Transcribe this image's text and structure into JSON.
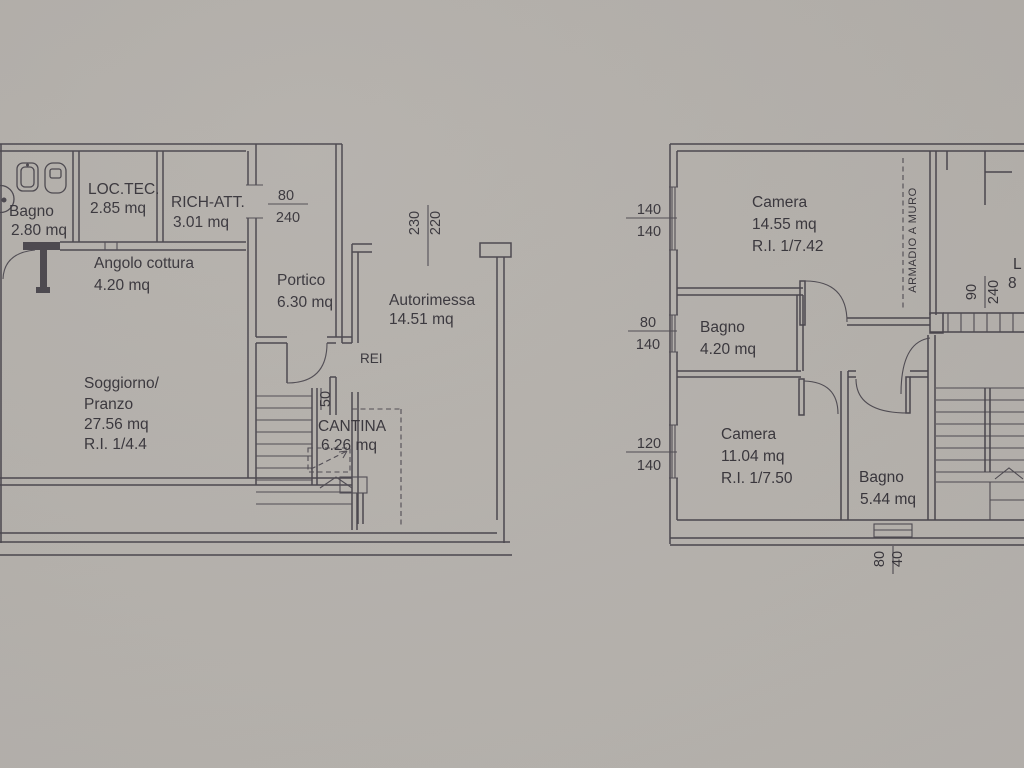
{
  "ground": {
    "rooms": {
      "bagno": {
        "name": "Bagno",
        "area": "2.80 mq"
      },
      "loc_tec": {
        "name": "LOC.TEC.",
        "area": "2.85 mq"
      },
      "rich_att": {
        "name": "RICH-ATT.",
        "area": "3.01 mq"
      },
      "angolo_cottura": {
        "name": "Angolo cottura",
        "area": "4.20 mq"
      },
      "portico": {
        "name": "Portico",
        "area": "6.30 mq"
      },
      "autorimessa": {
        "name": "Autorimessa",
        "area": "14.51 mq"
      },
      "soggiorno": {
        "name": "Soggiorno/",
        "name2": "Pranzo",
        "area": "27.56 mq",
        "ri": "R.I. 1/4.4"
      },
      "cantina": {
        "name": "CANTINA",
        "area": "6.26 mq"
      }
    },
    "annotations": {
      "fire_rating": "REI",
      "stair_width": "50"
    },
    "dimensions": {
      "door": {
        "w": "80",
        "h": "240"
      },
      "garage_door": {
        "w": "230",
        "h": "220"
      }
    }
  },
  "first": {
    "rooms": {
      "camera1": {
        "name": "Camera",
        "area": "14.55 mq",
        "ri": "R.I. 1/7.42"
      },
      "bagno1": {
        "name": "Bagno",
        "area": "4.20 mq"
      },
      "camera2": {
        "name": "Camera",
        "area": "11.04 mq",
        "ri": "R.I. 1/7.50"
      },
      "bagno2": {
        "name": "Bagno",
        "area": "5.44 mq"
      }
    },
    "annotations": {
      "wardrobe": "ARMADIO A MURO",
      "partial_label_1": "L",
      "partial_label_2": "8"
    },
    "dimensions": {
      "window1": {
        "w": "140",
        "h": "140"
      },
      "window2": {
        "w": "80",
        "h": "140"
      },
      "window3": {
        "w": "120",
        "h": "140"
      },
      "door": {
        "w": "90",
        "h": "240"
      },
      "vent": {
        "w": "80",
        "h": "40"
      }
    }
  }
}
